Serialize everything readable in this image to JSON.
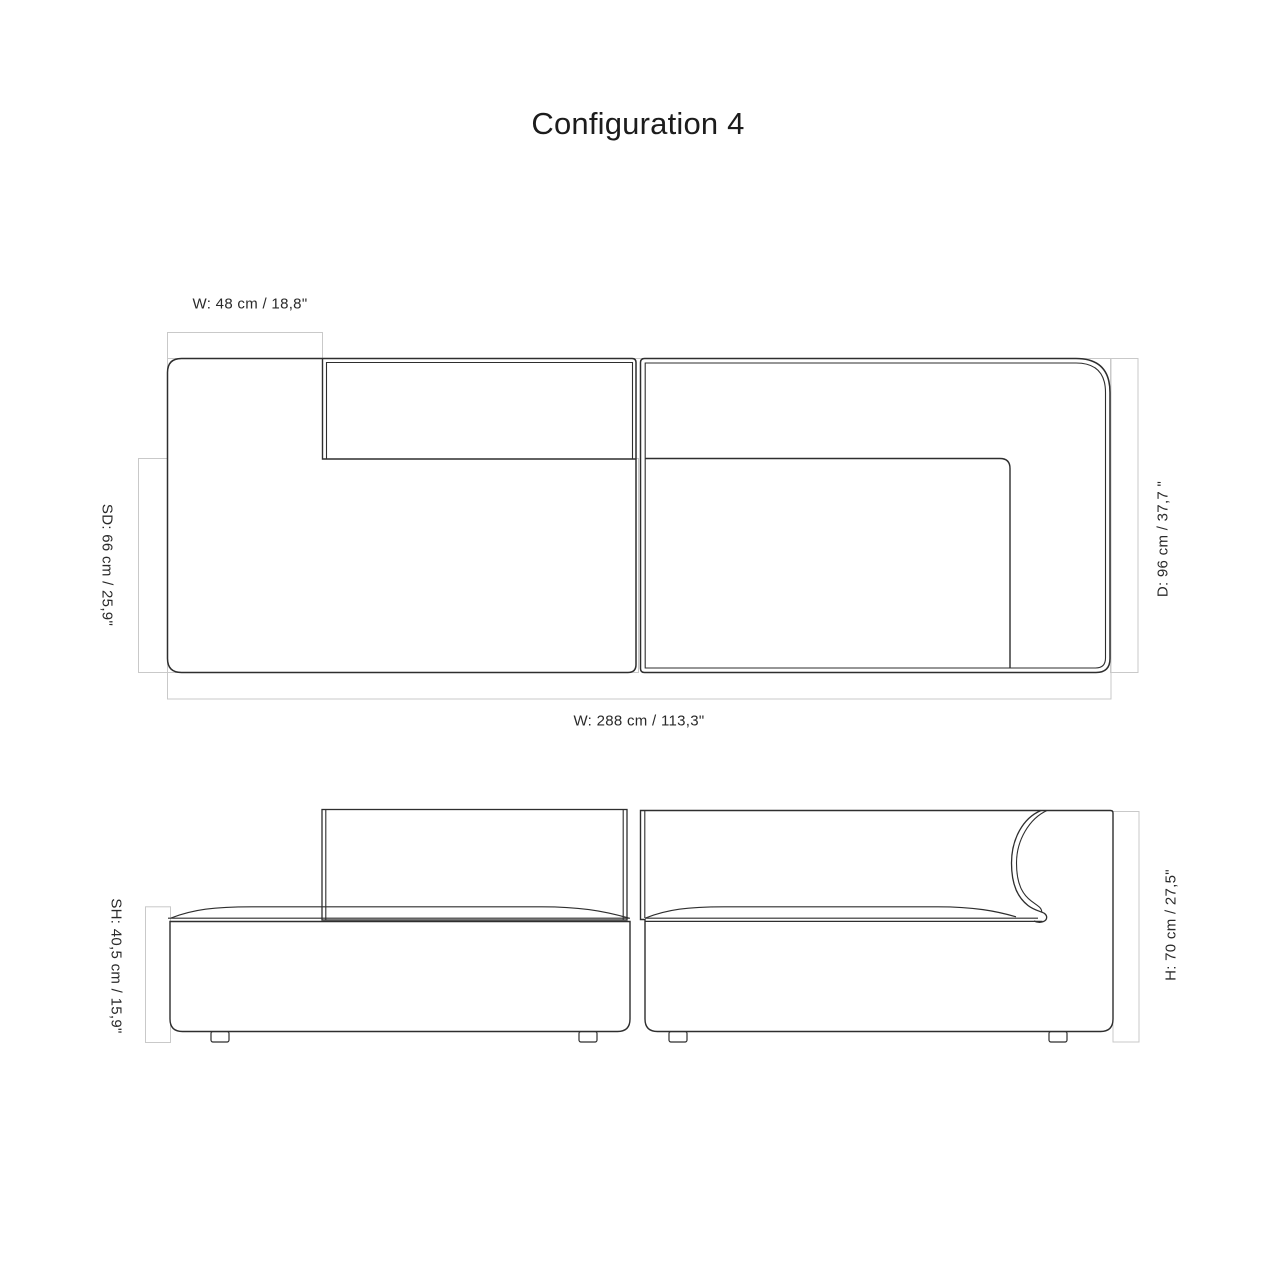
{
  "title": "Configuration 4",
  "views": {
    "top": {
      "name": "plan-view",
      "labels": {
        "module_width": "W: 48 cm / 18,8\"",
        "seat_depth": "SD: 66 cm / 25,9\"",
        "depth": "D: 96 cm / 37,7 \"",
        "total_width": "W: 288 cm / 113,3\""
      }
    },
    "front": {
      "name": "front-elevation-view",
      "labels": {
        "seat_height": "SH: 40,5 cm / 15,9\"",
        "height": "H: 70 cm / 27,5\""
      }
    }
  },
  "colors": {
    "outline": "#2e2e2e",
    "dimension_line": "#c9c9c9",
    "text": "#2a2a2a",
    "background": "#ffffff"
  }
}
